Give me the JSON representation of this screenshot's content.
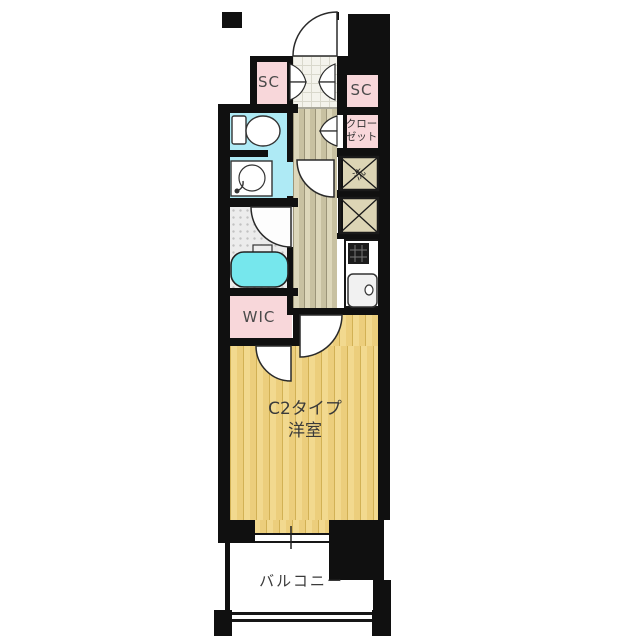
{
  "floorplan": {
    "unit_label": {
      "line1": "C2タイプ",
      "line2": "洋室"
    },
    "labels": {
      "shoe_closet_left": "SC",
      "shoe_closet_right": "SC",
      "closet_line1": "クロー",
      "closet_line2": "ゼット",
      "washer": "洗",
      "walk_in_closet": "WIC",
      "balcony": "バルコニー"
    },
    "colors": {
      "wall": "#101010",
      "closet_pink": "#f8d7da",
      "wet_area_blue": "#aeeaf5",
      "bathtub_cyan": "#76e7ed",
      "room_floor_yellow": "#f2d98f",
      "hall_floor_tan": "#ddd7ba"
    }
  }
}
